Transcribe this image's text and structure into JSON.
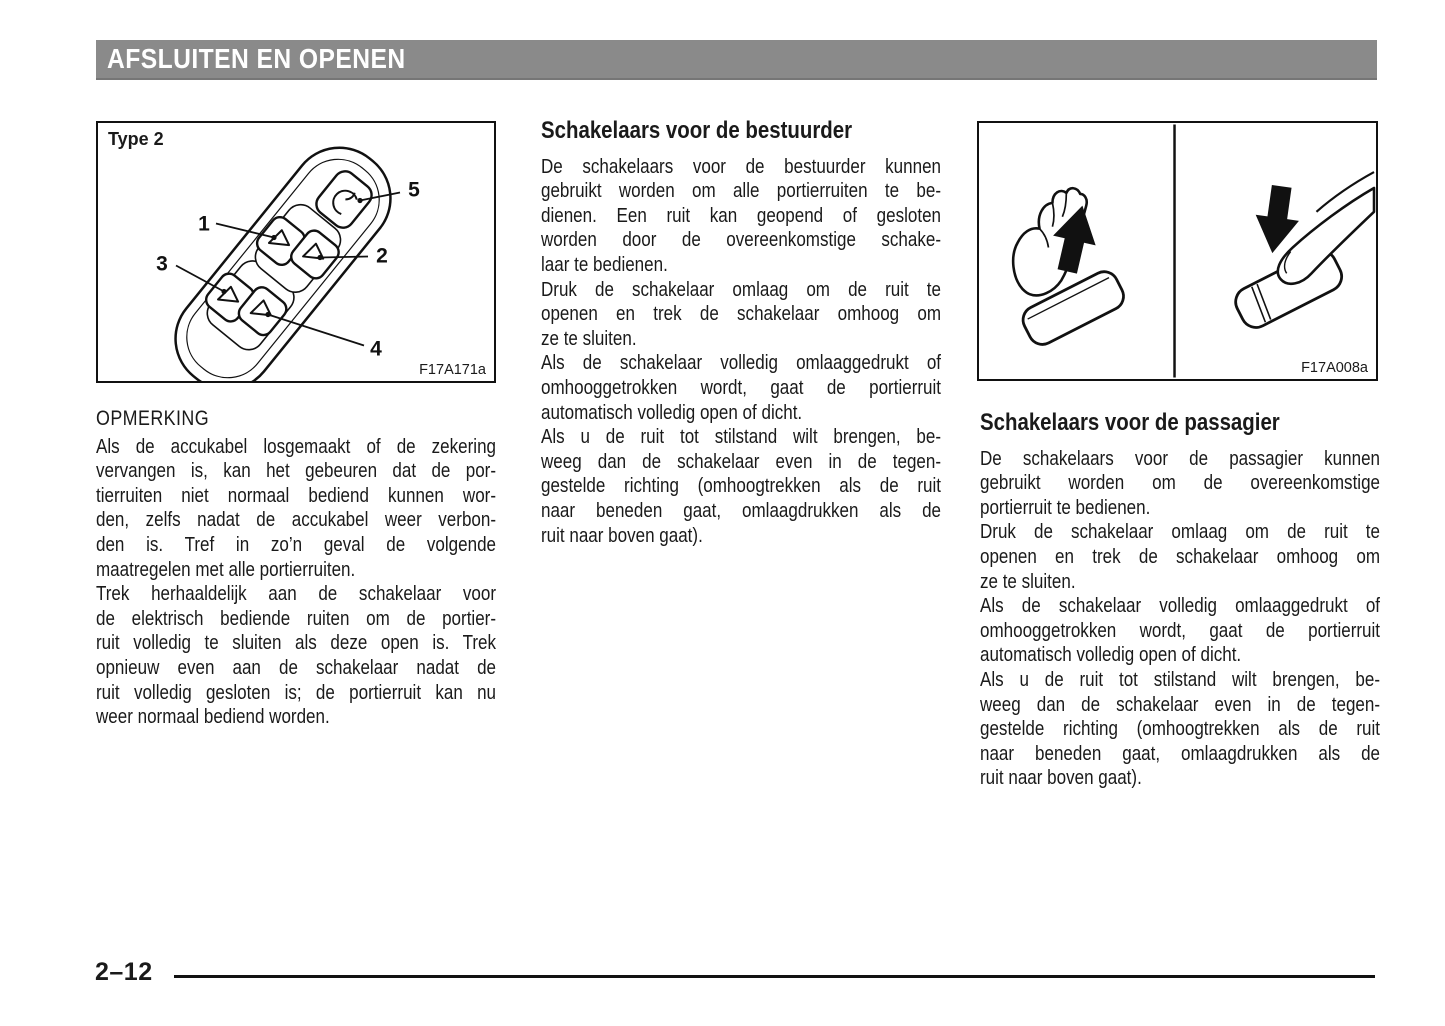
{
  "header": {
    "title": "AFSLUITEN EN OPENEN",
    "bar_color": "#8a8a8a"
  },
  "figures": {
    "switch_panel": {
      "label": "Type 2",
      "code": "F17A171a",
      "callouts": [
        "1",
        "2",
        "3",
        "4",
        "5"
      ]
    },
    "hand_operation": {
      "code": "F17A008a"
    }
  },
  "note": {
    "heading": "OPMERKING",
    "paragraphs": [
      [
        "Als de accukabel losgemaakt of de zekering",
        "vervangen is, kan het gebeuren dat de por-",
        "tierruiten niet normaal bediend kunnen wor-",
        "den, zelfs nadat de accukabel weer verbon-",
        "den is. Tref in zo’n geval de volgende",
        "maatregelen met alle portierruiten."
      ],
      [
        "Trek herhaaldelijk aan de schakelaar voor",
        "de elektrisch bediende ruiten om de portier-",
        "ruit volledig te sluiten als deze open is. Trek",
        "opnieuw even aan de schakelaar nadat de",
        "ruit volledig gesloten is; de portierruit kan nu",
        "weer normaal bediend worden."
      ]
    ]
  },
  "driver_section": {
    "heading": "Schakelaars voor de bestuurder",
    "paragraphs": [
      [
        "De schakelaars voor de bestuurder kunnen",
        "gebruikt worden om alle portierruiten te be-",
        "dienen. Een ruit kan geopend of gesloten",
        "worden door de overeenkomstige schake-",
        "laar te bedienen."
      ],
      [
        "Druk de schakelaar omlaag om de ruit te",
        "openen en trek de schakelaar omhoog om",
        "ze te sluiten."
      ],
      [
        "Als de schakelaar volledig omlaaggedrukt of",
        "omhooggetrokken wordt, gaat de portierruit",
        "automatisch volledig open of dicht."
      ],
      [
        "Als u de ruit tot stilstand wilt brengen, be-",
        "weeg dan de schakelaar even in de tegen-",
        "gestelde richting (omhoogtrekken als de ruit",
        "naar beneden gaat, omlaagdrukken als de",
        "ruit naar boven gaat)."
      ]
    ]
  },
  "passenger_section": {
    "heading": "Schakelaars voor de passagier",
    "paragraphs": [
      [
        "De schakelaars voor de passagier kunnen",
        "gebruikt worden om de overeenkomstige",
        "portierruit te bedienen."
      ],
      [
        "Druk de schakelaar omlaag om de ruit te",
        "openen en trek de schakelaar omhoog om",
        "ze te sluiten."
      ],
      [
        "Als de schakelaar volledig omlaaggedrukt of",
        "omhooggetrokken wordt, gaat de portierruit",
        "automatisch volledig open of dicht."
      ],
      [
        "Als u de ruit tot stilstand wilt brengen, be-",
        "weeg dan de schakelaar even in de tegen-",
        "gestelde richting (omhoogtrekken als de ruit",
        "naar beneden gaat, omlaagdrukken als de",
        "ruit naar boven gaat)."
      ]
    ]
  },
  "footer": {
    "page_number": "2–12"
  }
}
